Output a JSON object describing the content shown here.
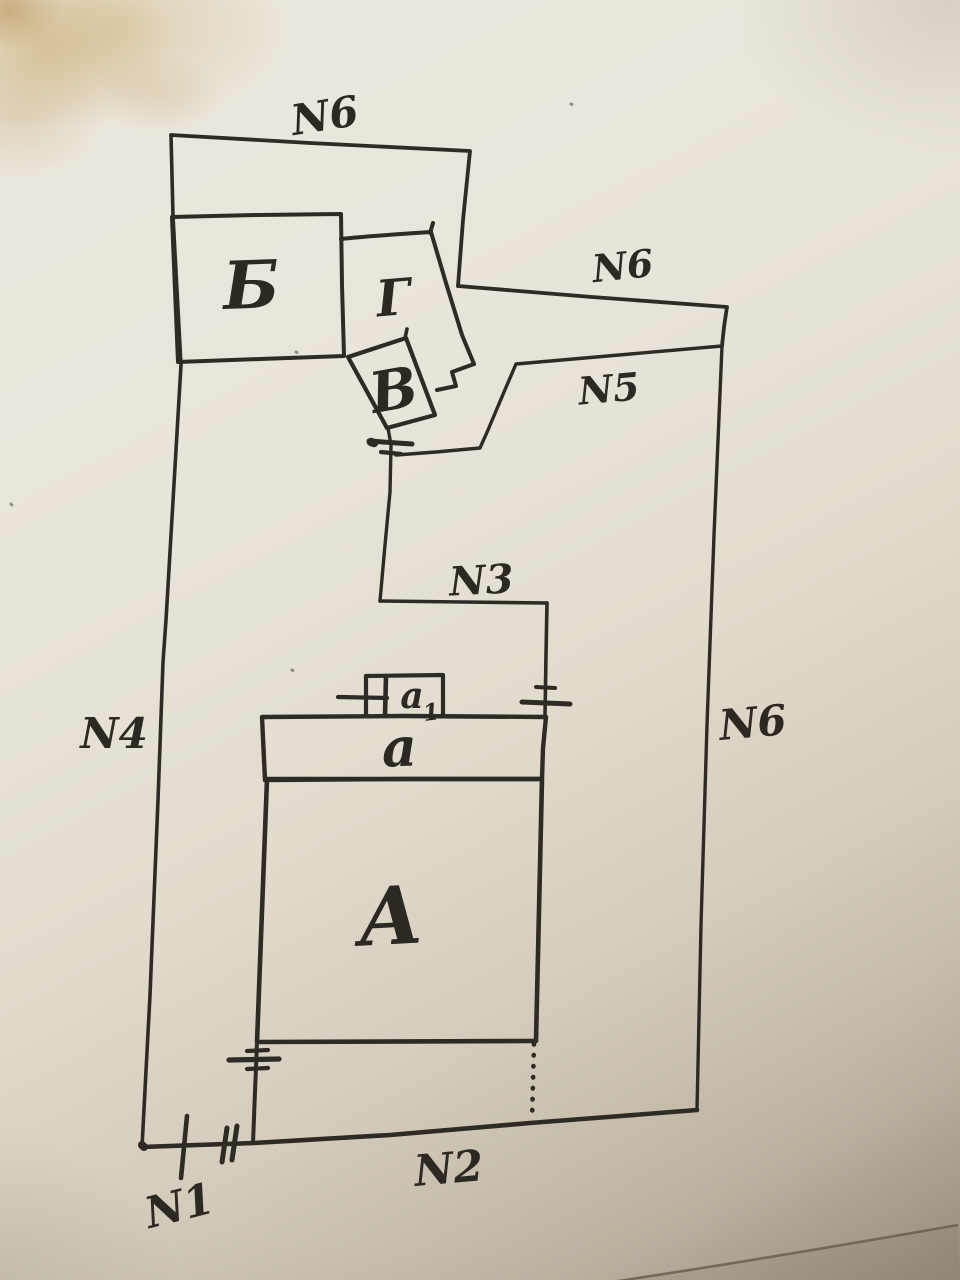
{
  "sketch": {
    "ink_color": "#2e2a24",
    "paper_color": "#e9e4da",
    "stain_color": "#c6a668",
    "labels": {
      "n1": "N1",
      "n2": "N2",
      "n3": "N3",
      "n4": "N4",
      "n5": "N5",
      "n6_top": "N6",
      "n6_upper_right": "N6",
      "n6_right": "N6"
    },
    "buildings": {
      "b": "Б",
      "g": "Г",
      "v": "В",
      "a": "А",
      "a_small": "а",
      "a1_base": "а",
      "a1_sub": "1"
    }
  }
}
